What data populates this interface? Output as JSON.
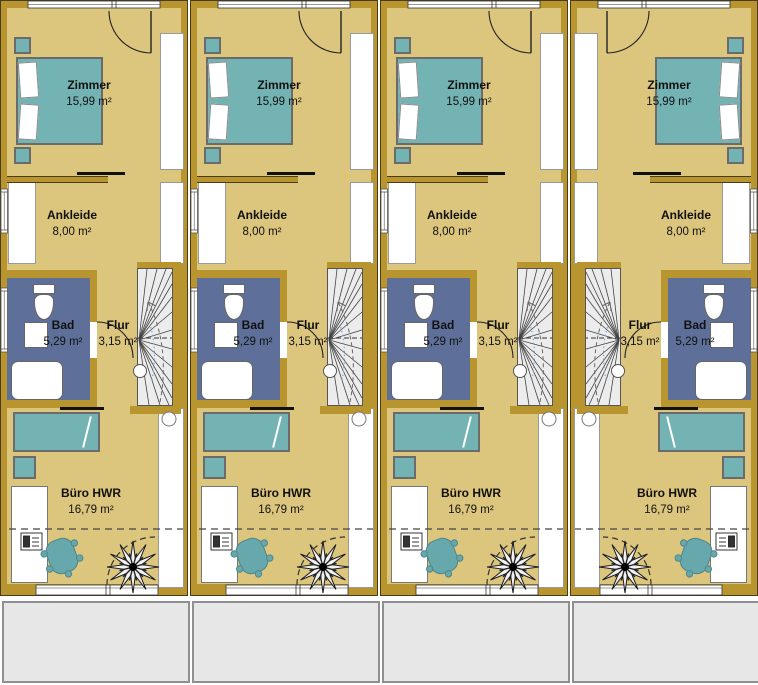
{
  "colors": {
    "wall": "#b9952f",
    "outline": "#4a3c16",
    "floor": "#dcc57d",
    "bath": "#5e7099",
    "teal": "#74b3b4",
    "tealBorder": "#6b6b6b",
    "stair": "#ececec",
    "terrace": "#e7e7e7",
    "ink": "#111111"
  },
  "floorplan": {
    "rooms": {
      "zimmer": {
        "name": "Zimmer",
        "area": "15,99 m²"
      },
      "ankleide": {
        "name": "Ankleide",
        "area": "8,00 m²"
      },
      "bad": {
        "name": "Bad",
        "area": "5,29 m²"
      },
      "flur": {
        "name": "Flur",
        "area": "3,15 m²"
      },
      "buero": {
        "name": "Büro HWR",
        "area": "16,79 m²"
      }
    },
    "units": [
      {
        "id": "unit-1",
        "mirrored": false
      },
      {
        "id": "unit-2",
        "mirrored": false
      },
      {
        "id": "unit-3",
        "mirrored": false
      },
      {
        "id": "unit-4",
        "mirrored": true
      }
    ]
  }
}
